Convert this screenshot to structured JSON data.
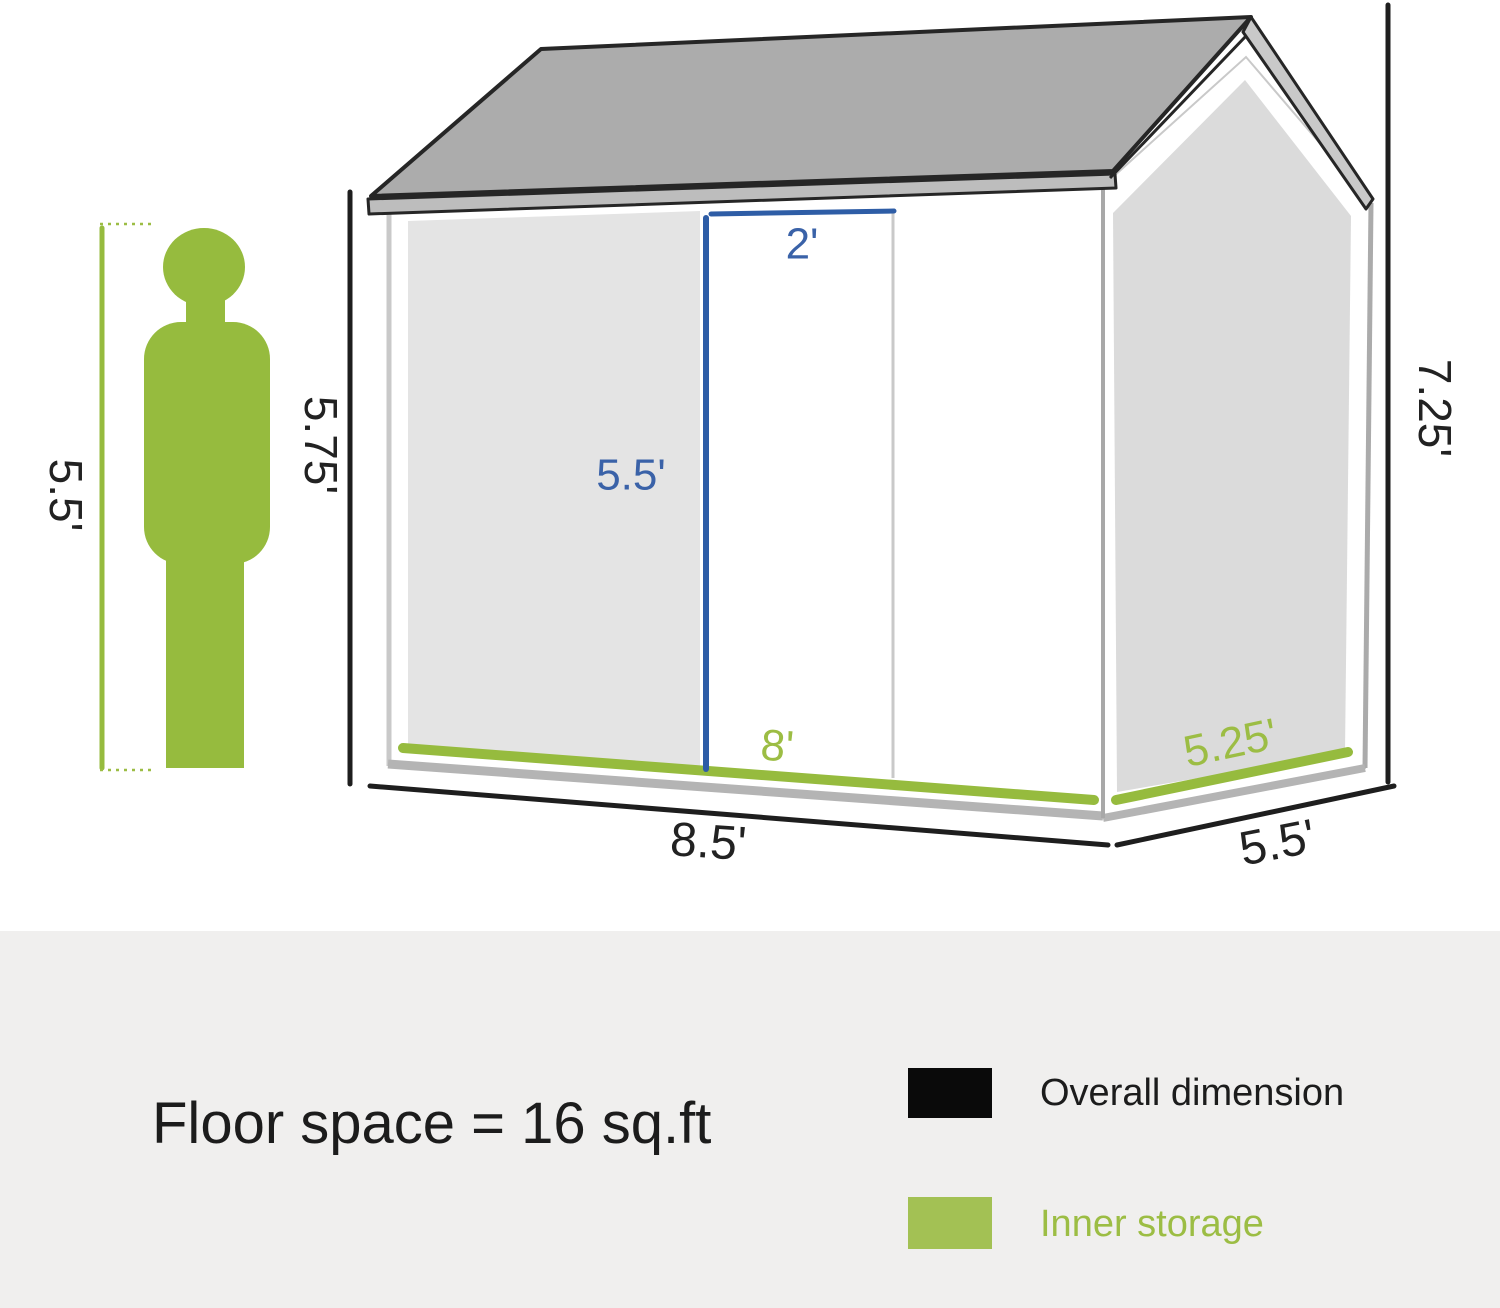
{
  "diagram": {
    "person": {
      "height_label": "5.5'"
    },
    "shed": {
      "overall": {
        "front_height": "5.75'",
        "gable_height": "7.25'",
        "front_width": "8.5'",
        "side_depth": "5.5'"
      },
      "door": {
        "width": "2'",
        "height": "5.5'"
      },
      "inner": {
        "front_width": "8'",
        "side_depth": "5.25'"
      }
    }
  },
  "footer": {
    "floor_space": "Floor space = 16 sq.ft",
    "legend": [
      {
        "label": "Overall dimension",
        "color": "#0a0a0a"
      },
      {
        "label": "Inner storage",
        "color": "#a3c154"
      }
    ]
  },
  "colors": {
    "accent_green": "#96bb3e",
    "accent_blue": "#2e5da6",
    "dimension_black": "#1e1e1e",
    "roof_gray": "#acacac",
    "panel_gray": "#dbdbdb",
    "footer_band": "#f0efee"
  }
}
